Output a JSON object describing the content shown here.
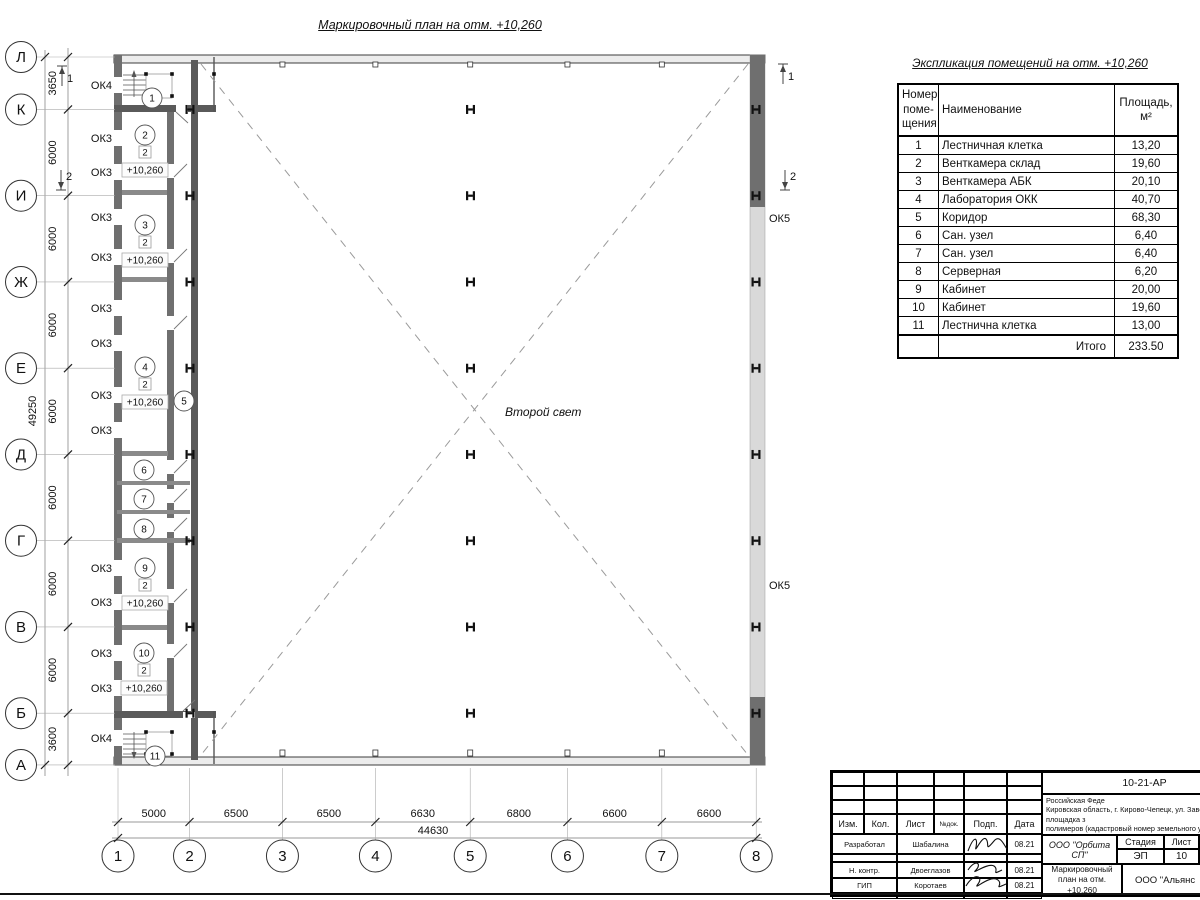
{
  "plan": {
    "title": "Маркировочный план на отм. +10,260",
    "second_light": "Второй свет",
    "row_axes": [
      "Л",
      "К",
      "И",
      "Ж",
      "Е",
      "Д",
      "Г",
      "В",
      "Б",
      "А"
    ],
    "row_dims": [
      "3650",
      "6000",
      "6000",
      "6000",
      "6000",
      "6000",
      "6000",
      "6000",
      "3600"
    ],
    "row_total": "49250",
    "col_axes": [
      "1",
      "2",
      "3",
      "4",
      "5",
      "6",
      "7",
      "8"
    ],
    "col_dims": [
      "5000",
      "6500",
      "6500",
      "6630",
      "6800",
      "6600",
      "6600"
    ],
    "col_total": "44630",
    "window_labels": [
      {
        "text": "ОК4",
        "y": 85
      },
      {
        "text": "ОК3",
        "y": 138
      },
      {
        "text": "ОК3",
        "y": 172
      },
      {
        "text": "ОК3",
        "y": 217
      },
      {
        "text": "ОК3",
        "y": 257
      },
      {
        "text": "ОК3",
        "y": 308
      },
      {
        "text": "ОК3",
        "y": 343
      },
      {
        "text": "ОК3",
        "y": 395
      },
      {
        "text": "ОК3",
        "y": 430
      },
      {
        "text": "ОК3",
        "y": 568
      },
      {
        "text": "ОК3",
        "y": 602
      },
      {
        "text": "ОК3",
        "y": 653
      },
      {
        "text": "ОК3",
        "y": 688
      },
      {
        "text": "ОК4",
        "y": 738
      }
    ],
    "right_window_labels": [
      {
        "text": "ОК5",
        "y": 218
      },
      {
        "text": "ОК5",
        "y": 585
      }
    ],
    "rooms": [
      {
        "num": "1",
        "x": 152,
        "y": 98
      },
      {
        "num": "2",
        "x": 145,
        "y": 135,
        "finish": "2",
        "elev": "+10,260"
      },
      {
        "num": "3",
        "x": 145,
        "y": 225,
        "finish": "2",
        "elev": "+10,260"
      },
      {
        "num": "4",
        "x": 145,
        "y": 367,
        "finish": "2",
        "elev": "+10,260"
      },
      {
        "num": "5",
        "x": 184,
        "y": 401
      },
      {
        "num": "6",
        "x": 144,
        "y": 470
      },
      {
        "num": "7",
        "x": 144,
        "y": 499
      },
      {
        "num": "8",
        "x": 144,
        "y": 529
      },
      {
        "num": "9",
        "x": 145,
        "y": 568,
        "finish": "2",
        "elev": "+10,260"
      },
      {
        "num": "10",
        "x": 144,
        "y": 653,
        "finish": "2",
        "elev": "+10,260"
      },
      {
        "num": "11",
        "x": 155,
        "y": 756
      }
    ],
    "section_marks": [
      {
        "label": "1",
        "x": 62,
        "y": 76,
        "dir": "up"
      },
      {
        "label": "2",
        "x": 61,
        "y": 180,
        "dir": "down"
      },
      {
        "label": "1",
        "x": 783,
        "y": 74,
        "dir": "up"
      },
      {
        "label": "2",
        "x": 785,
        "y": 180,
        "dir": "down"
      }
    ]
  },
  "table": {
    "title": "Экспликация помещений на отм. +10,260",
    "col1_header": "Номер\nпоме-\nщения",
    "col2_header": "Наименование",
    "col3_header": "Площадь,\nм²",
    "rows": [
      {
        "num": "1",
        "name": "Лестничная клетка",
        "area": "13,20"
      },
      {
        "num": "2",
        "name": "Венткамера склад",
        "area": "19,60"
      },
      {
        "num": "3",
        "name": "Венткамера АБК",
        "area": "20,10"
      },
      {
        "num": "4",
        "name": "Лаборатория ОКК",
        "area": "40,70"
      },
      {
        "num": "5",
        "name": "Коридор",
        "area": "68,30"
      },
      {
        "num": "6",
        "name": "Сан. узел",
        "area": "6,40"
      },
      {
        "num": "7",
        "name": "Сан. узел",
        "area": "6,40"
      },
      {
        "num": "8",
        "name": "Серверная",
        "area": "6,20"
      },
      {
        "num": "9",
        "name": "Кабинет",
        "area": "20,00"
      },
      {
        "num": "10",
        "name": "Кабинет",
        "area": "19,60"
      },
      {
        "num": "11",
        "name": "Лестнична клетка",
        "area": "13,00"
      }
    ],
    "total_label": "Итого",
    "total_value": "233.50"
  },
  "titleblock": {
    "doc_number": "10-21-АР",
    "description": "Здание склада АБК, расположенное по адресу: Российская Феде\nКировская область, г. Кирово-Чепецк, ул. Заводская, площадка з\nполимеров (кадастровый номер земельного участка 43:42:0000",
    "cols": [
      "Изм.",
      "Кол.",
      "Лист",
      "№док.",
      "Подп.",
      "Дата"
    ],
    "signers": [
      {
        "role": "Разработал",
        "name": "Шабалина",
        "date": "08.21"
      },
      {
        "role": "Н. контр.",
        "name": "Двоеглазов",
        "date": "08.21"
      },
      {
        "role": "ГИП",
        "name": "Коротаев",
        "date": "08.21"
      }
    ],
    "org": "ООО \"Орбита СП\"",
    "stage_label": "Стадия",
    "sheet_label": "Лист",
    "sheets_label": "Листов",
    "stage": "ЭП",
    "sheet": "10",
    "sheets": "1",
    "sheet_title": "Маркировочный план на отм.\n+10,260",
    "org2": "ООО \"Альянс"
  },
  "colors": {
    "wall_dark": "#6f6f6f",
    "wall_light": "#ececec",
    "window_band": "#d9d9d9",
    "dash": "#9a9a9a",
    "line": "#1a1a1a"
  }
}
